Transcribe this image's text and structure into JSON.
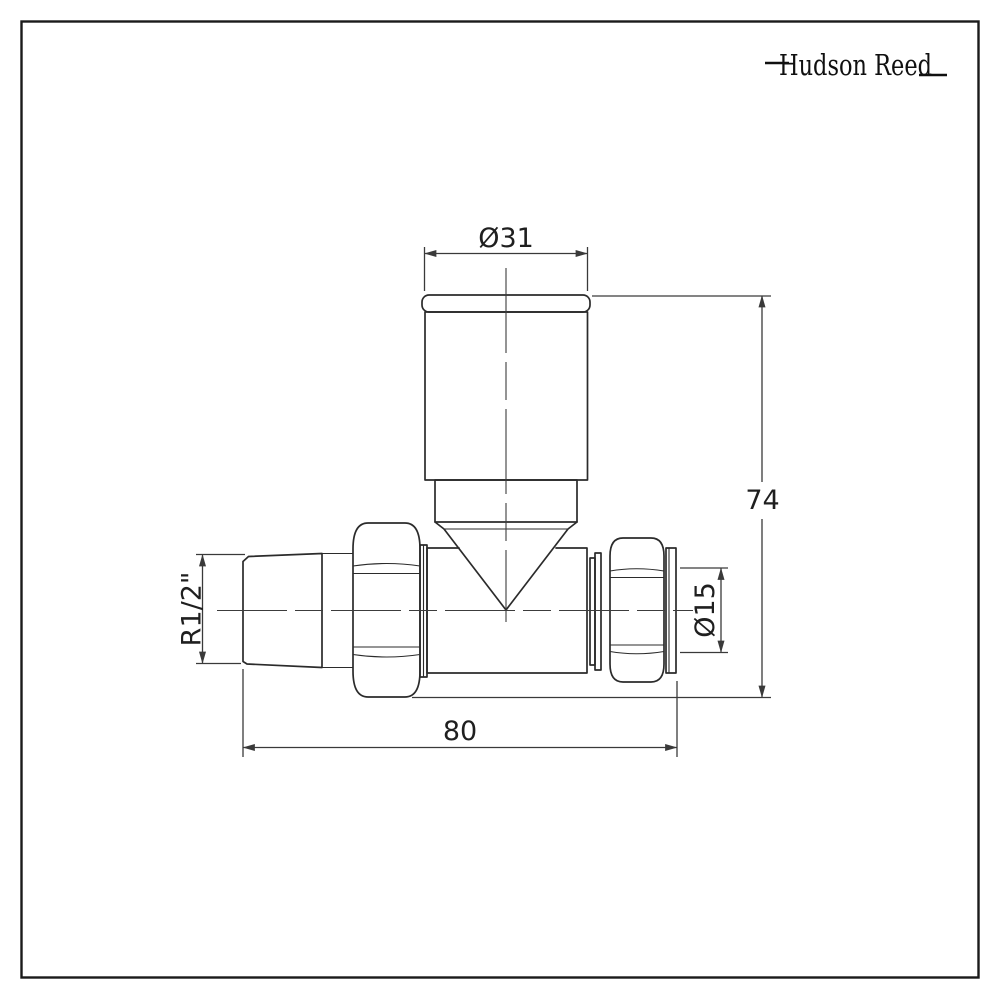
{
  "page": {
    "background": "#ffffff",
    "border_color": "#1a1a1a"
  },
  "logo": {
    "text": "Hudson Reed",
    "color": "#101010"
  },
  "drawing": {
    "line_color": "#2b2b2b",
    "dimension_color": "#3a3a3a",
    "labels": {
      "head_diameter": "Ø31",
      "overall_height": "74",
      "inlet_thread": "R1/2\"",
      "pipe_diameter": "Ø15",
      "overall_length": "80"
    }
  }
}
